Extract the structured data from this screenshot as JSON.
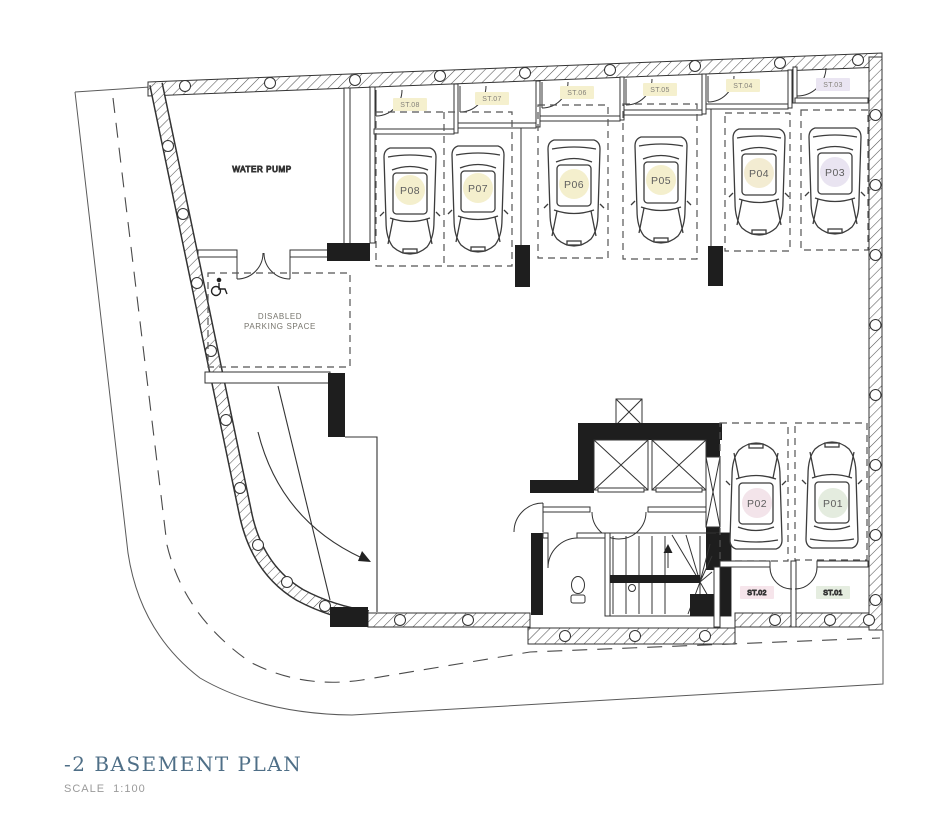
{
  "title": {
    "text": "-2 BASEMENT PLAN",
    "scale": "SCALE  1:100"
  },
  "rooms": {
    "water_pump": "WATER PUMP",
    "disabled_line1": "DISABLED",
    "disabled_line2": "PARKING SPACE"
  },
  "parking_spaces": [
    {
      "id": "P08",
      "color": "#f4efcd"
    },
    {
      "id": "P07",
      "color": "#f4efcd"
    },
    {
      "id": "P06",
      "color": "#f4efcd"
    },
    {
      "id": "P05",
      "color": "#f4efcd"
    },
    {
      "id": "P04",
      "color": "#f3ecd2"
    },
    {
      "id": "P03",
      "color": "#e9e4f1"
    },
    {
      "id": "P02",
      "color": "#f3e4ea"
    },
    {
      "id": "P01",
      "color": "#e4ecdf"
    }
  ],
  "storage_units": [
    {
      "id": "ST.08",
      "color": "#f5f0ce"
    },
    {
      "id": "ST.07",
      "color": "#f5f0ce"
    },
    {
      "id": "ST.06",
      "color": "#f5f0ce"
    },
    {
      "id": "ST.05",
      "color": "#f5f0ce"
    },
    {
      "id": "ST.04",
      "color": "#f5f0ce"
    },
    {
      "id": "ST.03",
      "color": "#eae5f2"
    },
    {
      "id": "ST.02",
      "color": "#f6e5eb"
    },
    {
      "id": "ST.01",
      "color": "#e5ede0"
    }
  ]
}
